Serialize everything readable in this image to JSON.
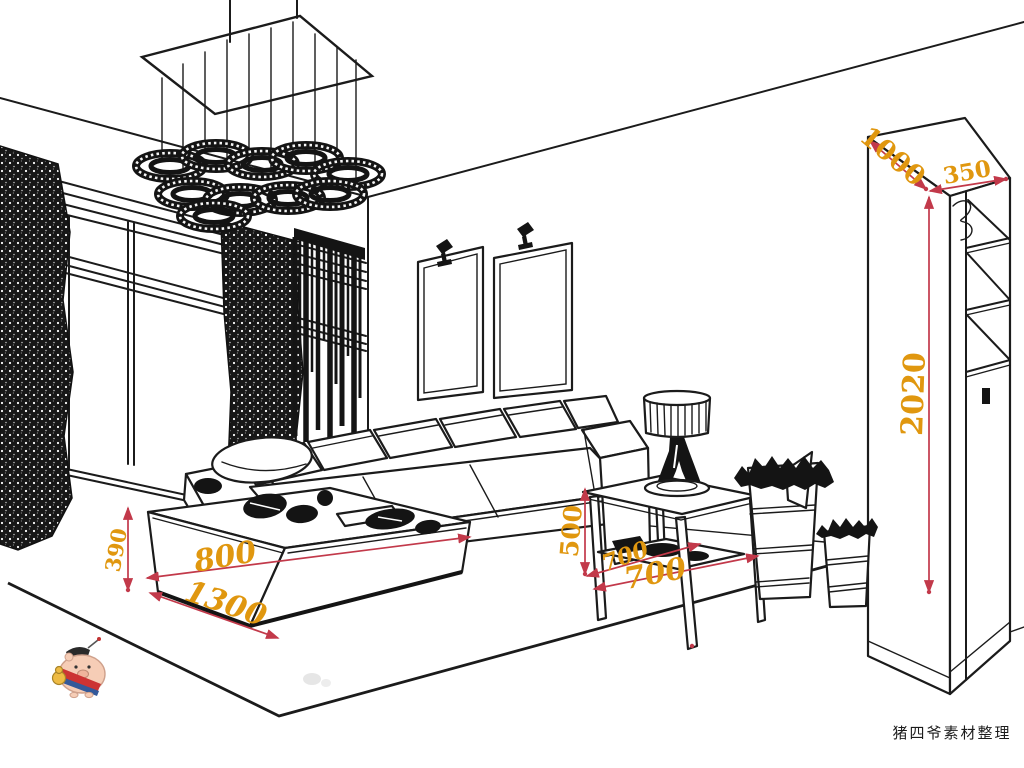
{
  "scene": {
    "description": "Black-and-white perspective line sketch of a living room interior with furniture dimension annotations in millimetres",
    "objects": [
      "chandelier",
      "curtain-left",
      "curtain-right",
      "striped-sheer-curtain",
      "french-window",
      "picture-frame-1",
      "picture-frame-2",
      "wall-spotlight-1",
      "wall-spotlight-2",
      "sectional-sofa",
      "round-throw-pillow",
      "coffee-table",
      "side-table",
      "table-lamp",
      "waste-basket-large",
      "waste-basket-small",
      "display-cabinet",
      "area-rug",
      "pig-mascot-watermark"
    ]
  },
  "colors": {
    "background": "#ffffff",
    "line_ink": "#1b1b1b",
    "dimension_text": "#e0970f",
    "dimension_line": "#c2394a"
  },
  "annotations": {
    "cabinet": {
      "width": "1000",
      "depth": "350",
      "height": "2020"
    },
    "coffee_table": {
      "height": "390",
      "depth": "800",
      "length": "1300"
    },
    "side_table": {
      "height": "500",
      "depth": "700",
      "width": "700"
    }
  },
  "watermark": {
    "credit": "猪四爷素材整理"
  }
}
